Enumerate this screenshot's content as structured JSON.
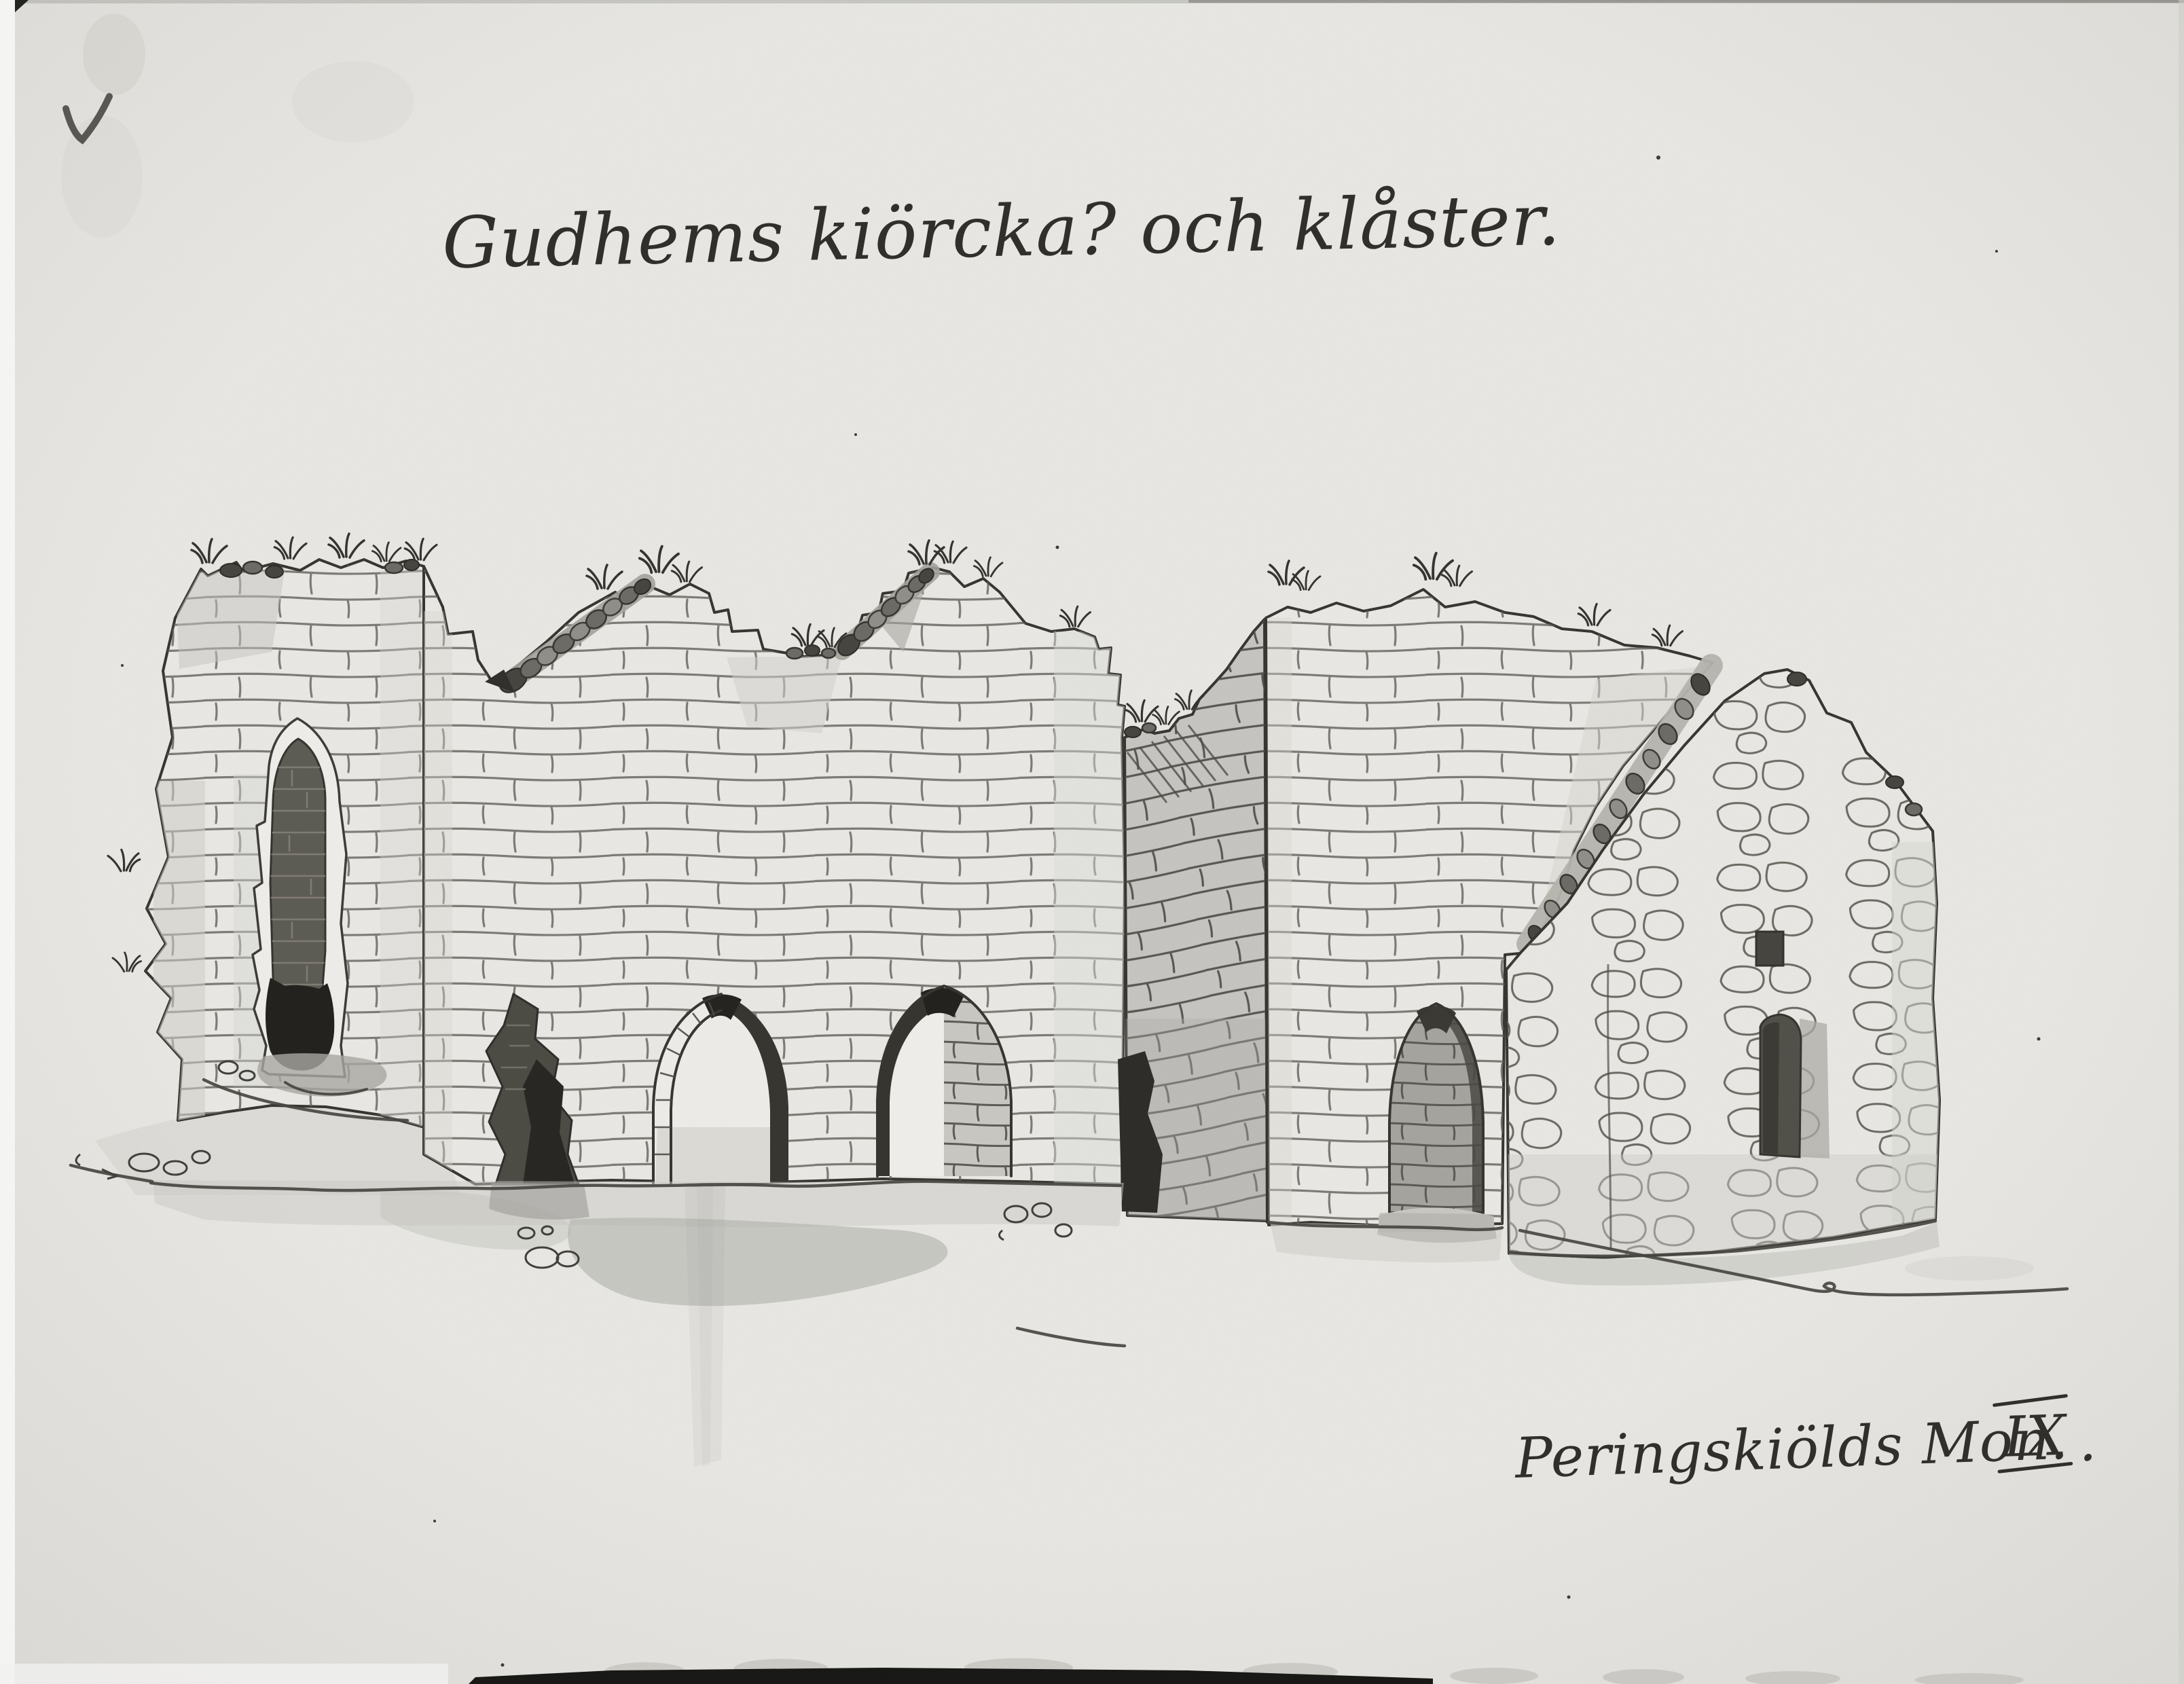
{
  "document": {
    "kind": "scanned ink-and-wash drawing",
    "title_inscription": "Gudhems kiörcka? och klåster.",
    "caption": {
      "prefix": "Peringskiölds Mon.",
      "numeral": "IX",
      "suffix": "."
    },
    "pencil_checkmark_glyph": "✓"
  },
  "illustration": {
    "alt": "Ruins of Gudhem church and monastery: broken ashlar walls with pointed arch openings, a tall lancet window in the left tower fragment, a shaded return wall, and a rubble-stone gable wall with two small windows at right, drawn in ink with grey wash on paper."
  },
  "palette": {
    "paper": "#e9e8e4",
    "ink": "#2e2d2a",
    "brick_line": "#5d5c55",
    "wash_light": "#d6d5d0",
    "wash_mid": "#b7b6b1",
    "wash_dark": "#8f8e88",
    "opening_dark": "#2c2b27",
    "scan_edge_black": "#161614"
  }
}
